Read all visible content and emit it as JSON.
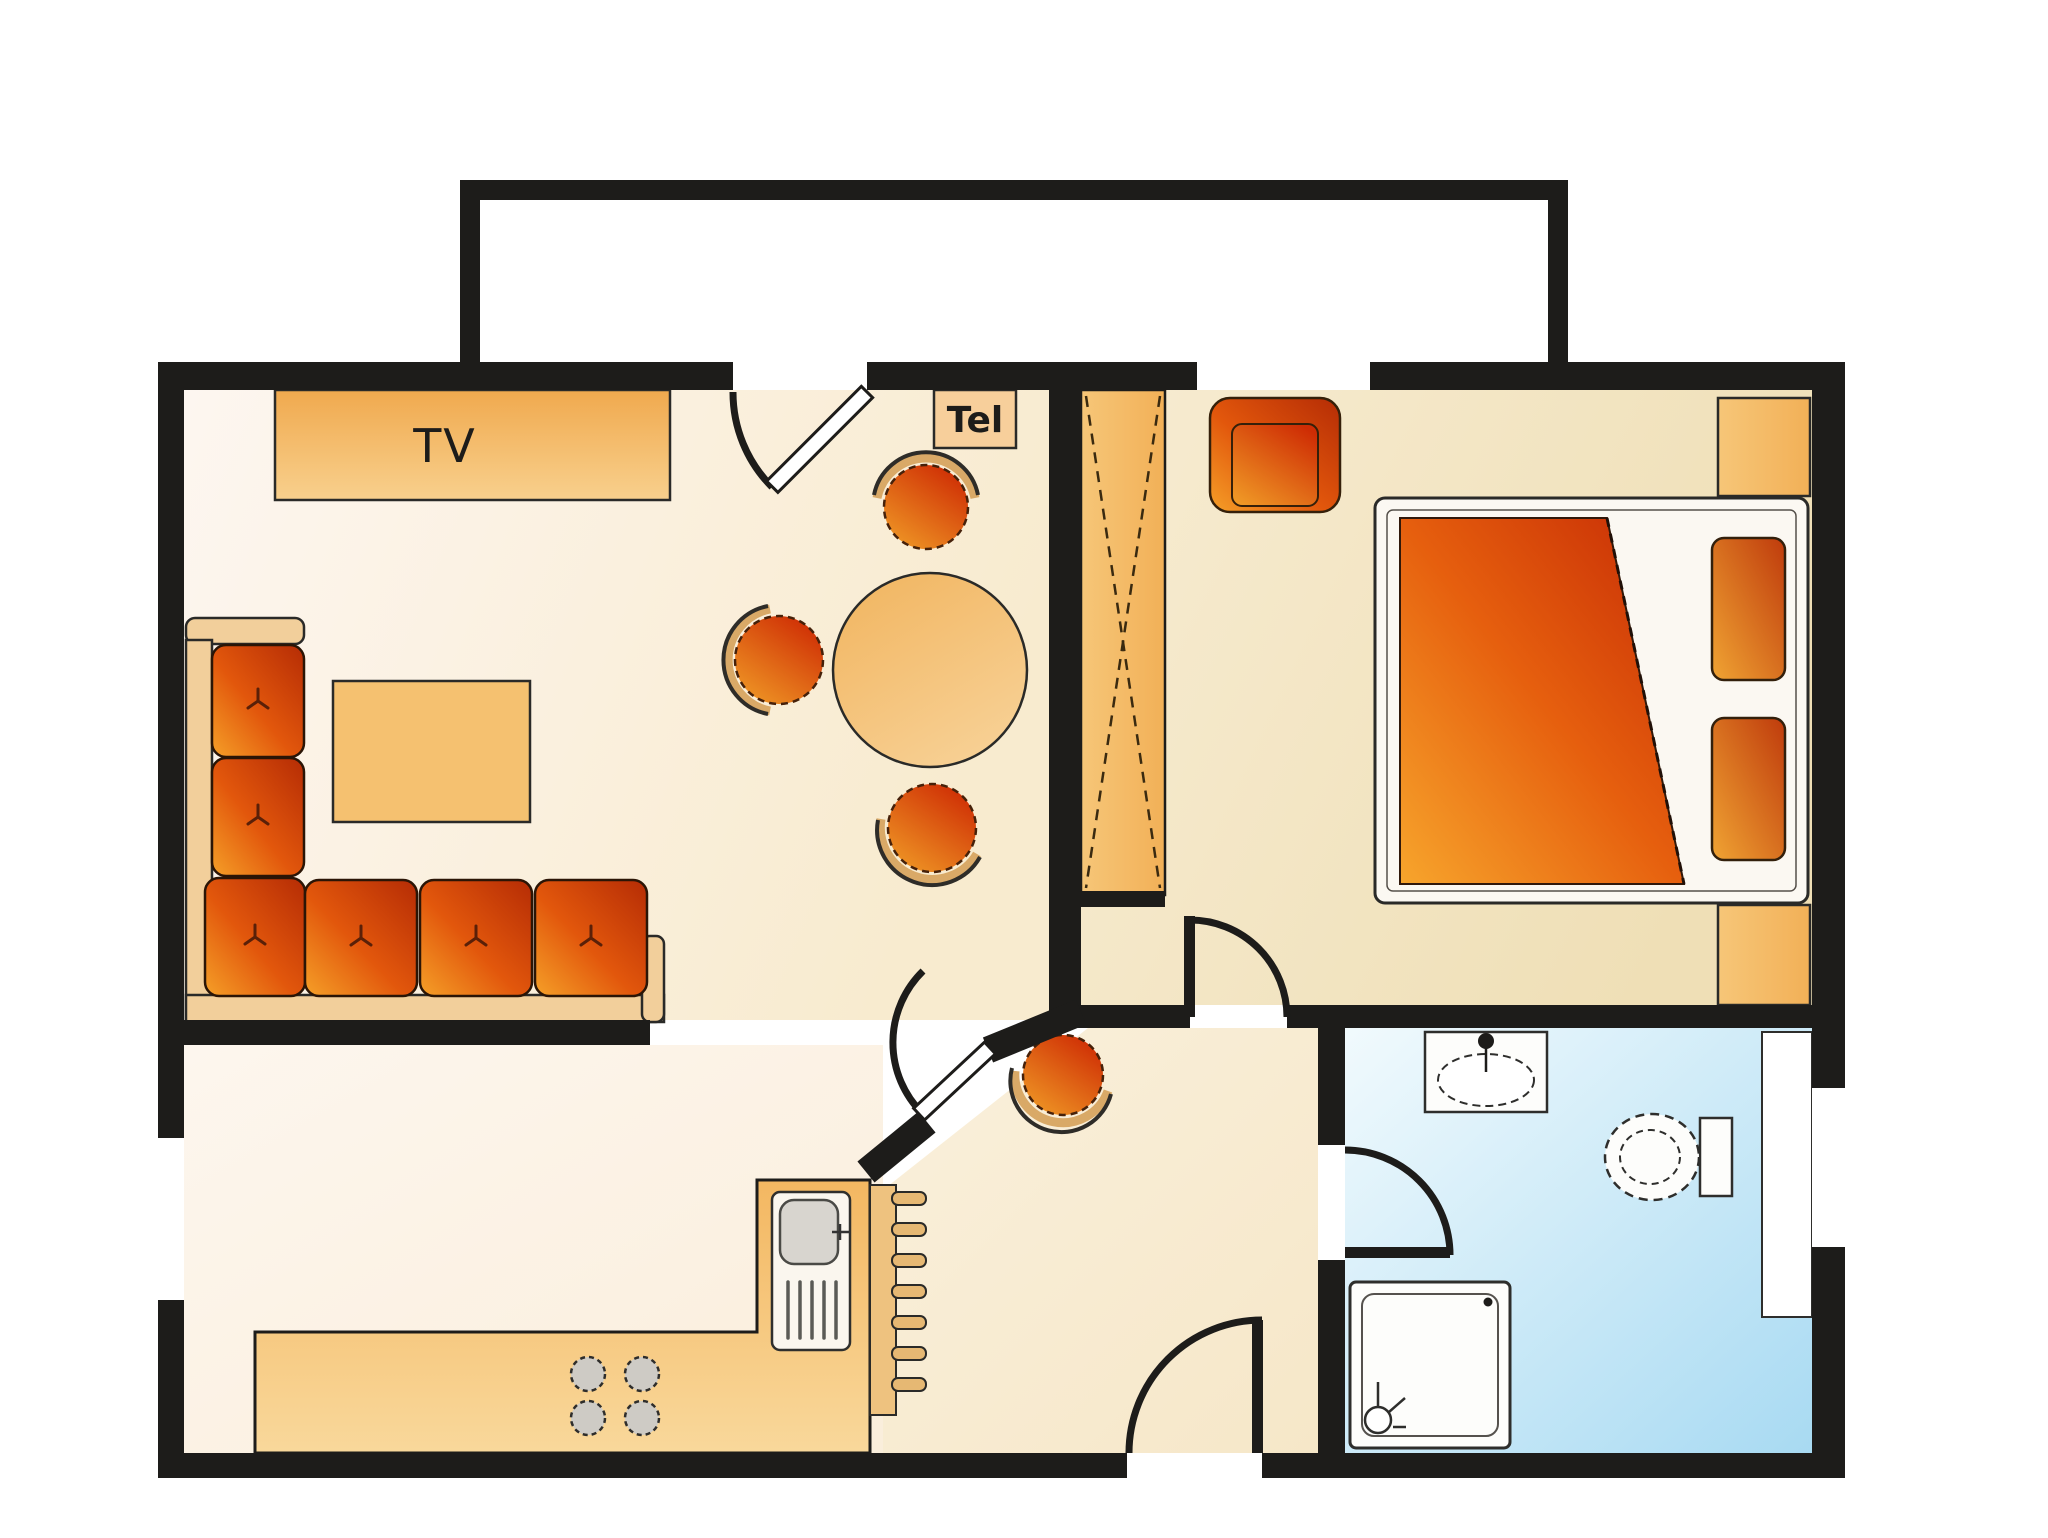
{
  "labels": {
    "tv": "TV",
    "tel": "Tel"
  },
  "colors": {
    "wall": "#1d1c1a",
    "floor-living": "#fdf5ec",
    "floor-cream": "#f8ecd4",
    "floor-bedroom": "#f3e6c4",
    "bathroom-blue": "#a8daf2",
    "furniture-orange": "#f2b45c",
    "furniture-orange-light": "#f7d9a0",
    "accent-red": "#c22f06",
    "accent-orange": "#f09a26",
    "fixture-white": "#fdfdfb"
  }
}
